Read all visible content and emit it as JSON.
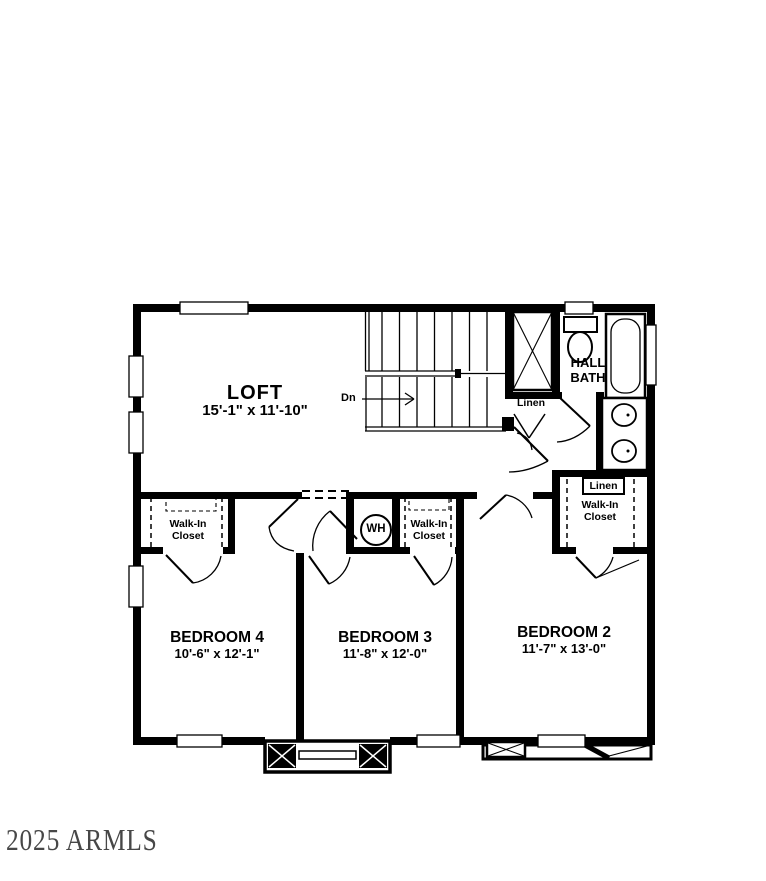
{
  "colors": {
    "ink": "#000000",
    "paper": "#ffffff",
    "watermark": "#2e2e2e"
  },
  "watermark": {
    "text": "2025 ARMLS"
  },
  "plan": {
    "loft": {
      "name": "LOFT",
      "dims": "15'-1\" x 11'-10\""
    },
    "bedroom4": {
      "name": "BEDROOM 4",
      "dims": "10'-6\" x 12'-1\""
    },
    "bedroom3": {
      "name": "BEDROOM 3",
      "dims": "11'-8\" x 12'-0\""
    },
    "bedroom2": {
      "name": "BEDROOM 2",
      "dims": "11'-7\" x 13'-0\""
    },
    "hall_bath": {
      "name": "HALL BATH"
    },
    "closets": {
      "bedroom4": "Walk-In Closet",
      "bedroom3": "Walk-In Closet",
      "bedroom2": "Walk-In Closet"
    },
    "linen_hall": {
      "label": "Linen"
    },
    "linen_bedroom2": {
      "label": "Linen"
    },
    "water_heater": {
      "label": "WH"
    },
    "stairs": {
      "direction_label": "Dn"
    }
  }
}
